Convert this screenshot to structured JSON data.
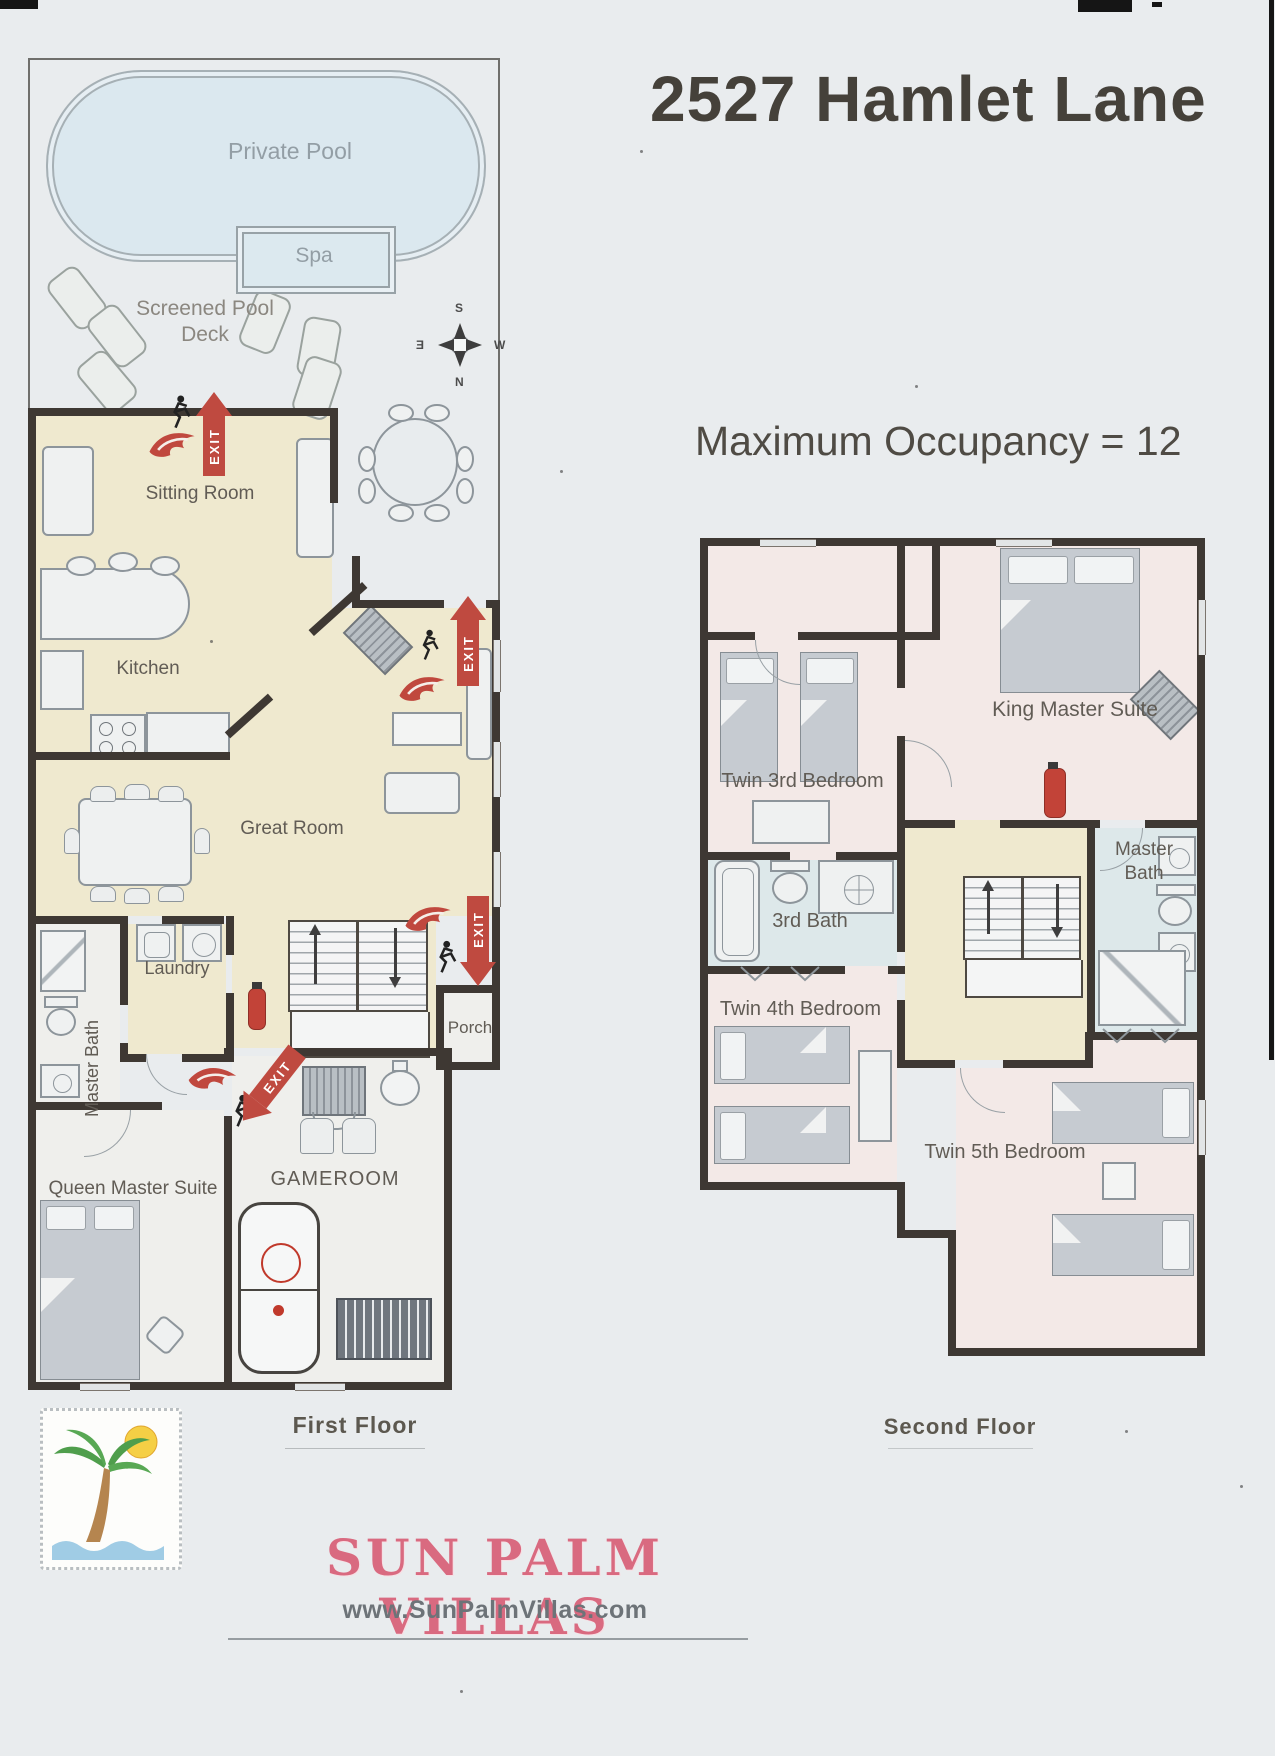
{
  "header": {
    "title": "2527 Hamlet Lane",
    "occupancy": "Maximum Occupancy = 12"
  },
  "labels": {
    "exit": "EXIT",
    "first_floor": "First Floor",
    "second_floor": "Second Floor"
  },
  "compass": {
    "n": "N",
    "s": "S",
    "e": "E",
    "w": "W"
  },
  "outdoor": {
    "pool": "Private Pool",
    "spa": "Spa",
    "deck": "Screened Pool Deck"
  },
  "first_floor_rooms": {
    "sitting_room": "Sitting Room",
    "kitchen": "Kitchen",
    "great_room": "Great Room",
    "laundry": "Laundry",
    "master_bath": "Master Bath",
    "porch": "Porch",
    "queen_master_suite": "Queen Master Suite",
    "gameroom": "GAMEROOM"
  },
  "second_floor_rooms": {
    "twin_3rd_bedroom": "Twin 3rd Bedroom",
    "king_master_suite": "King Master Suite",
    "third_bath": "3rd Bath",
    "master_bath": "Master Bath",
    "twin_4th_bedroom": "Twin 4th Bedroom",
    "twin_5th_bedroom": "Twin 5th Bedroom"
  },
  "footer": {
    "brand": "SUN PALM VILLAS",
    "website": "www.SunPalmVillas.com"
  }
}
